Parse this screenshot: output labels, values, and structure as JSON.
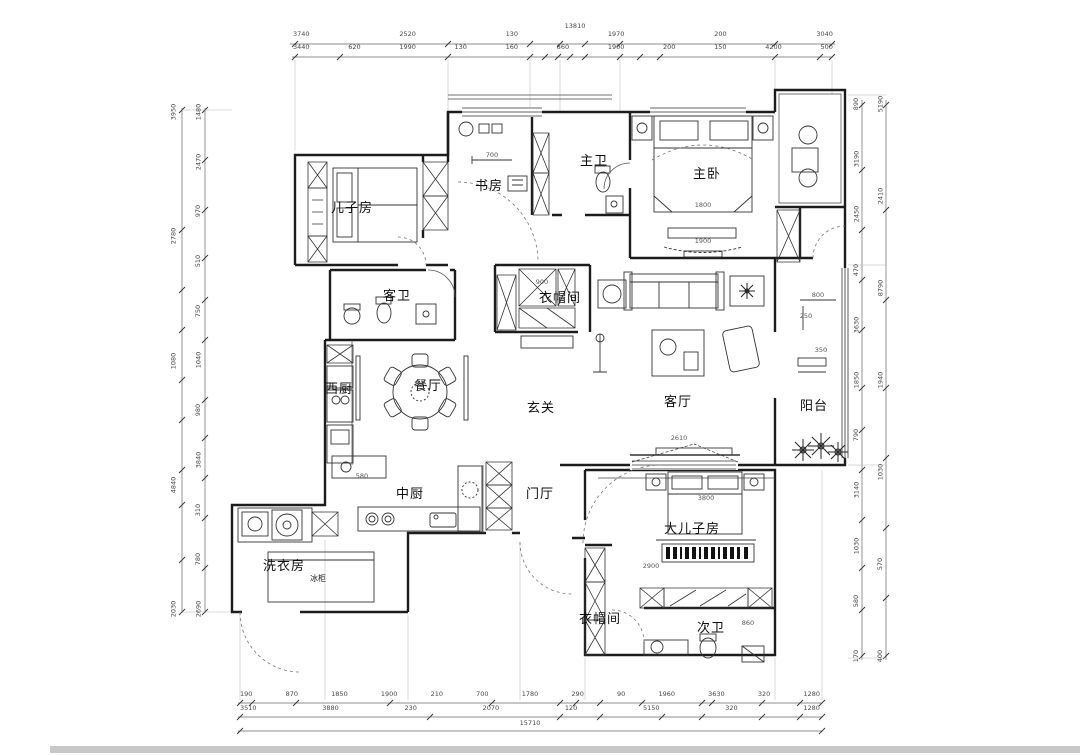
{
  "drawing": {
    "type": "apartment-floor-plan",
    "rooms": {
      "sons_room": "儿子房",
      "study": "书房",
      "master_bath": "主卫",
      "master_bedroom": "主卧",
      "guest_bath": "客卫",
      "cloakroom_upper": "衣帽间",
      "west_kitchen": "西厨",
      "dining": "餐厅",
      "entry_hall": "玄关",
      "living": "客厅",
      "balcony": "阳台",
      "chinese_kitchen": "中厨",
      "foyer": "门厅",
      "laundry": "洗衣房",
      "elder_sons_room": "大儿子房",
      "cloakroom_lower": "衣帽间",
      "second_bath": "次卫",
      "freezer": "冰柜"
    },
    "dimensions": {
      "top_total": "13810",
      "top_row1": [
        "3740",
        "2520",
        "130",
        "1970",
        "200",
        "3040"
      ],
      "top_row2": [
        "3440",
        "620",
        "1990",
        "130",
        "160",
        "860",
        "1900",
        "200",
        "150",
        "4200",
        "500"
      ],
      "bottom_row1": [
        "190",
        "870",
        "1850",
        "1900",
        "210",
        "700",
        "1780",
        "290",
        "90",
        "1960",
        "3630",
        "320",
        "1280"
      ],
      "bottom_row2": [
        "3510",
        "3880",
        "230",
        "2070",
        "120",
        "5150",
        "320",
        "1280"
      ],
      "bottom_total": "15710",
      "left_col1": [
        "3950",
        "2780",
        "1080",
        "4840",
        "2030"
      ],
      "left_col2": [
        "1480",
        "2470",
        "970",
        "510",
        "750",
        "1040",
        "980",
        "3840",
        "310",
        "780",
        "2690"
      ],
      "right_col1": [
        "890",
        "3190",
        "2450",
        "470",
        "3630",
        "1850",
        "790",
        "3140",
        "1030",
        "580",
        "170"
      ],
      "right_col2": [
        "5190",
        "2410",
        "8790",
        "1940",
        "1030",
        "570",
        "400"
      ]
    },
    "inner_dims": {
      "study_w": "700",
      "master_bed_w": "1800",
      "master_bed_l": "1900",
      "tv_wall": "2610",
      "balcony_a": "350",
      "balcony_b": "800",
      "balcony_c": "250",
      "boy_bed": "2900",
      "boy_room": "3800",
      "closet": "900",
      "kitchen_counter": "580",
      "bath_fix": "860"
    }
  }
}
